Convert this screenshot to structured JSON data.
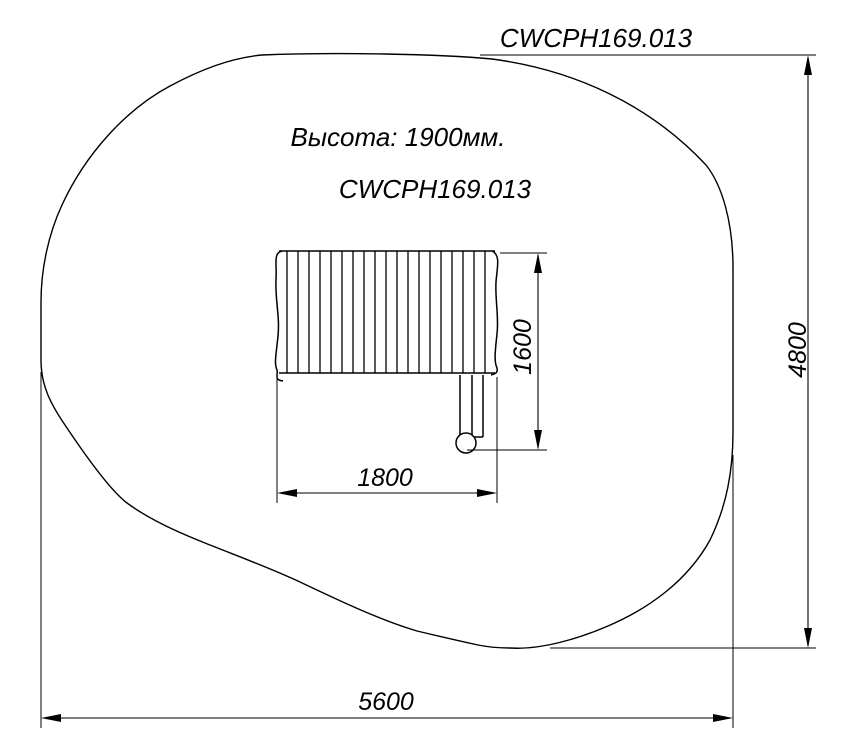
{
  "drawing": {
    "top_code": "CWCPH169.013",
    "height_note": "Высота: 1900мм.",
    "model_code": "CWCPH169.013",
    "dimensions": {
      "equipment_width": "1800",
      "equipment_depth": "1600",
      "zone_height": "4800",
      "zone_width": "5600"
    },
    "colors": {
      "line": "#000000",
      "background": "#ffffff"
    }
  }
}
